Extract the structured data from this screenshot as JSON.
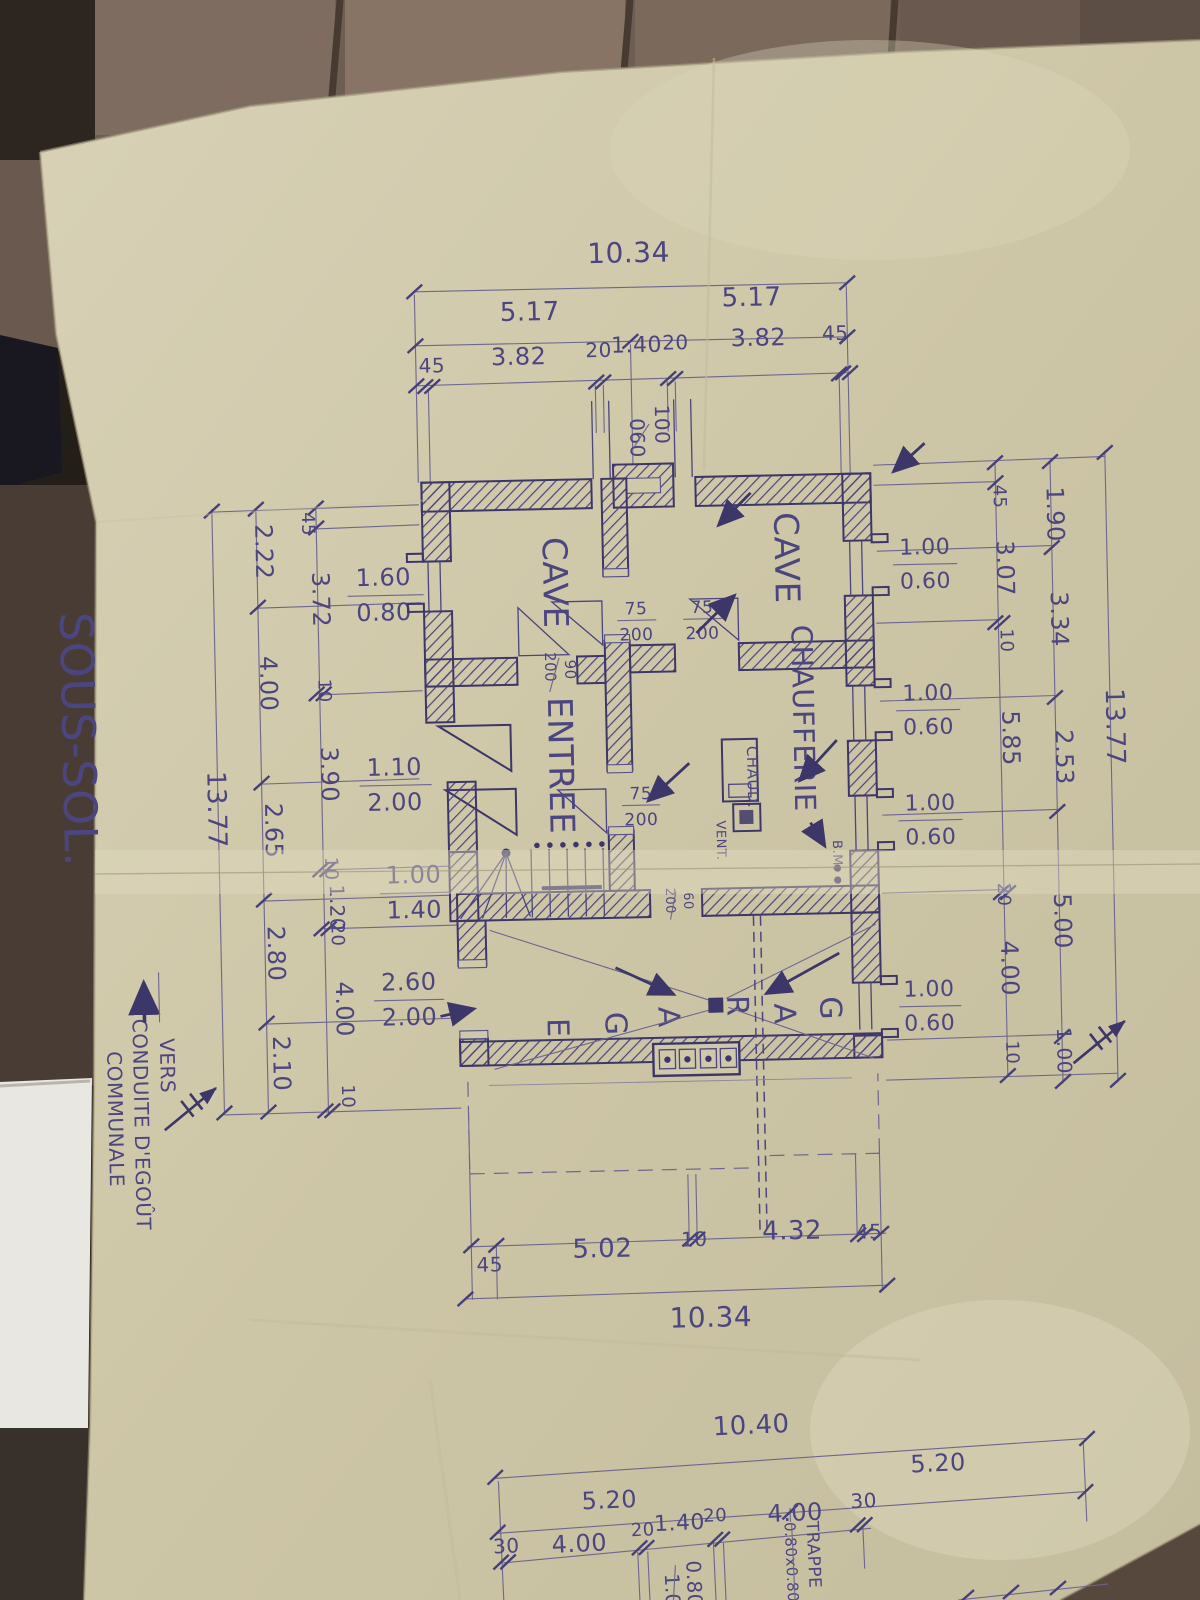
{
  "sheet": {
    "title": "SOUS-SOL.",
    "ink_color": "#3d3769",
    "pencil_color": "#6e6690",
    "paper_color": "#cfc7a8"
  },
  "rooms": {
    "cave": "CAVE",
    "entree": "ENTREE",
    "chaufferie": "CHAUFFERIE",
    "garage_letters": [
      "G",
      "A",
      "R",
      "A",
      "G",
      "E"
    ]
  },
  "equipment": {
    "boiler": "CHAUD.",
    "vent": "VENT.",
    "benchmark": "B.M."
  },
  "notes": {
    "sewer": [
      "VERS",
      "CONDUITE D'EGOÛT",
      "COMMUNALE"
    ],
    "hatch_label": "TRAPPE",
    "hatch_size": "0.80x0.80"
  },
  "doors": {
    "interior_75": {
      "w": "75",
      "h": "200"
    },
    "interior_90": {
      "w": "90",
      "h": "200"
    },
    "interior_60": {
      "w": "60",
      "h": "200"
    },
    "entrance": {
      "w": "1.10",
      "h": "2.00"
    },
    "garage_side": {
      "w": "2.60",
      "h": "2.00"
    }
  },
  "windows": {
    "small_right": {
      "w": "1.00",
      "h": "0.60"
    },
    "cave_left": {
      "w": "1.60",
      "h": "0.80"
    },
    "stair": {
      "w": "1.00",
      "h": "1.40"
    },
    "axis_top": {
      "w": "100",
      "h": "060"
    }
  },
  "dimensions": {
    "top": {
      "total": "10.34",
      "halves": [
        "5.17",
        "5.17"
      ],
      "segments": [
        "45",
        "3.82",
        "20",
        "1.40",
        "20",
        "3.82",
        "45"
      ]
    },
    "bottom": {
      "segments": [
        "45",
        "5.02",
        "10",
        "4.32",
        "45"
      ],
      "total": "10.34"
    },
    "right": {
      "inner": [
        "45",
        "3.07",
        "10",
        "5.85",
        "20",
        "4.00",
        "10"
      ],
      "middle": [
        "1.90",
        "3.34",
        "2.53",
        "5.00",
        "1.00"
      ],
      "total": "13.77"
    },
    "left": {
      "inner": [
        "45",
        "3.72",
        "10",
        "3.90",
        "10",
        "1.20",
        "20",
        "4.00",
        "10"
      ],
      "middle": [
        "2.22",
        "4.00",
        "2.65",
        "2.80",
        "2.10"
      ],
      "total": "13.77"
    },
    "lower_plan": {
      "total": "10.40",
      "halves": [
        "5.20",
        "5.20"
      ],
      "segments": [
        "30",
        "4.00",
        "20",
        "1.40",
        "20",
        "4.00",
        "30"
      ],
      "shaft": [
        "1.00",
        "0.80"
      ]
    }
  }
}
